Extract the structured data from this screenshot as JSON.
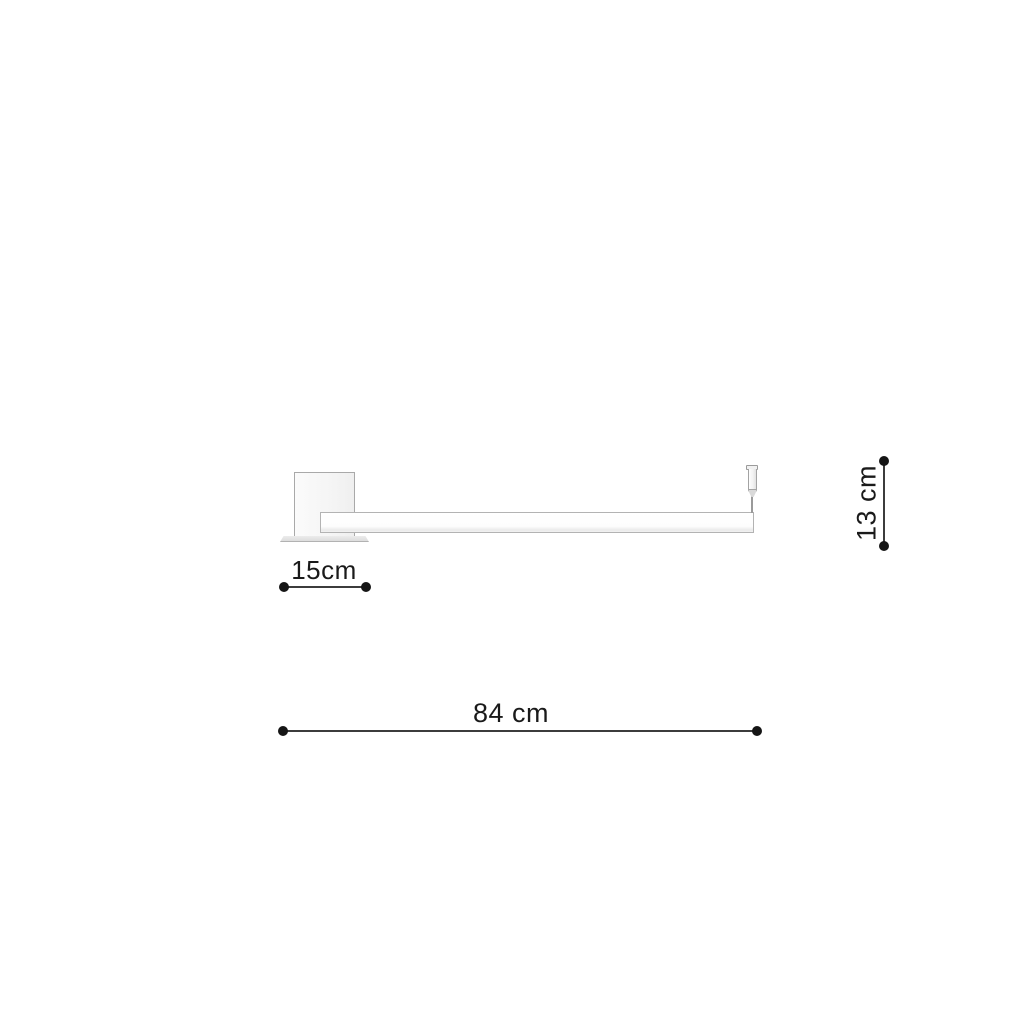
{
  "diagram": {
    "kind": "product-dimension-drawing",
    "dimensions": {
      "canopy_width": {
        "label": "15cm",
        "value": 15,
        "unit": "cm",
        "orientation": "horizontal"
      },
      "total_length": {
        "label": "84 cm",
        "value": 84,
        "unit": "cm",
        "orientation": "horizontal"
      },
      "fixture_height": {
        "label": "13 cm",
        "value": 13,
        "unit": "cm",
        "orientation": "vertical"
      }
    },
    "colors": {
      "background": "#ffffff",
      "dimension_marks": "#1a1a1a",
      "fixture_outline": "#a9a9a9",
      "fixture_fill": "#f7f7f7"
    }
  }
}
